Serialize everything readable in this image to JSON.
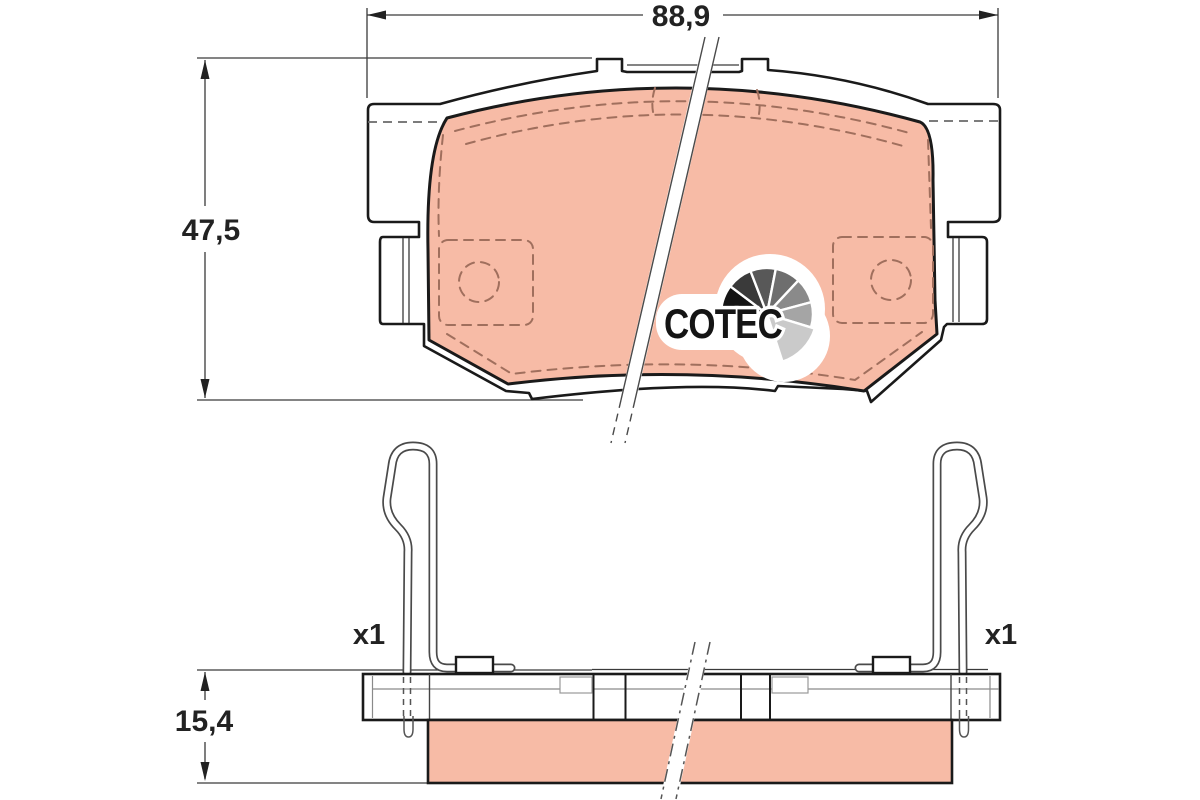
{
  "drawing": {
    "type": "brake-pad-technical-drawing",
    "views": {
      "top_view": "brake pad seen from friction surface",
      "side_view": "brake pad edge view with wear-indicator spring clips"
    },
    "dimensions": {
      "width_mm": "88,9",
      "height_mm": "47,5",
      "thickness_mm": "15,4"
    },
    "accessories": {
      "left_clip_quantity": "x1",
      "right_clip_quantity": "x1"
    },
    "logo": {
      "brand_text": "COTEC"
    },
    "colors": {
      "friction_material": "#f7bba6",
      "outline": "#1a1a1a",
      "detail_dashes": "#a06f5d",
      "dimension_lines": "#333333",
      "background": "#ffffff"
    }
  }
}
